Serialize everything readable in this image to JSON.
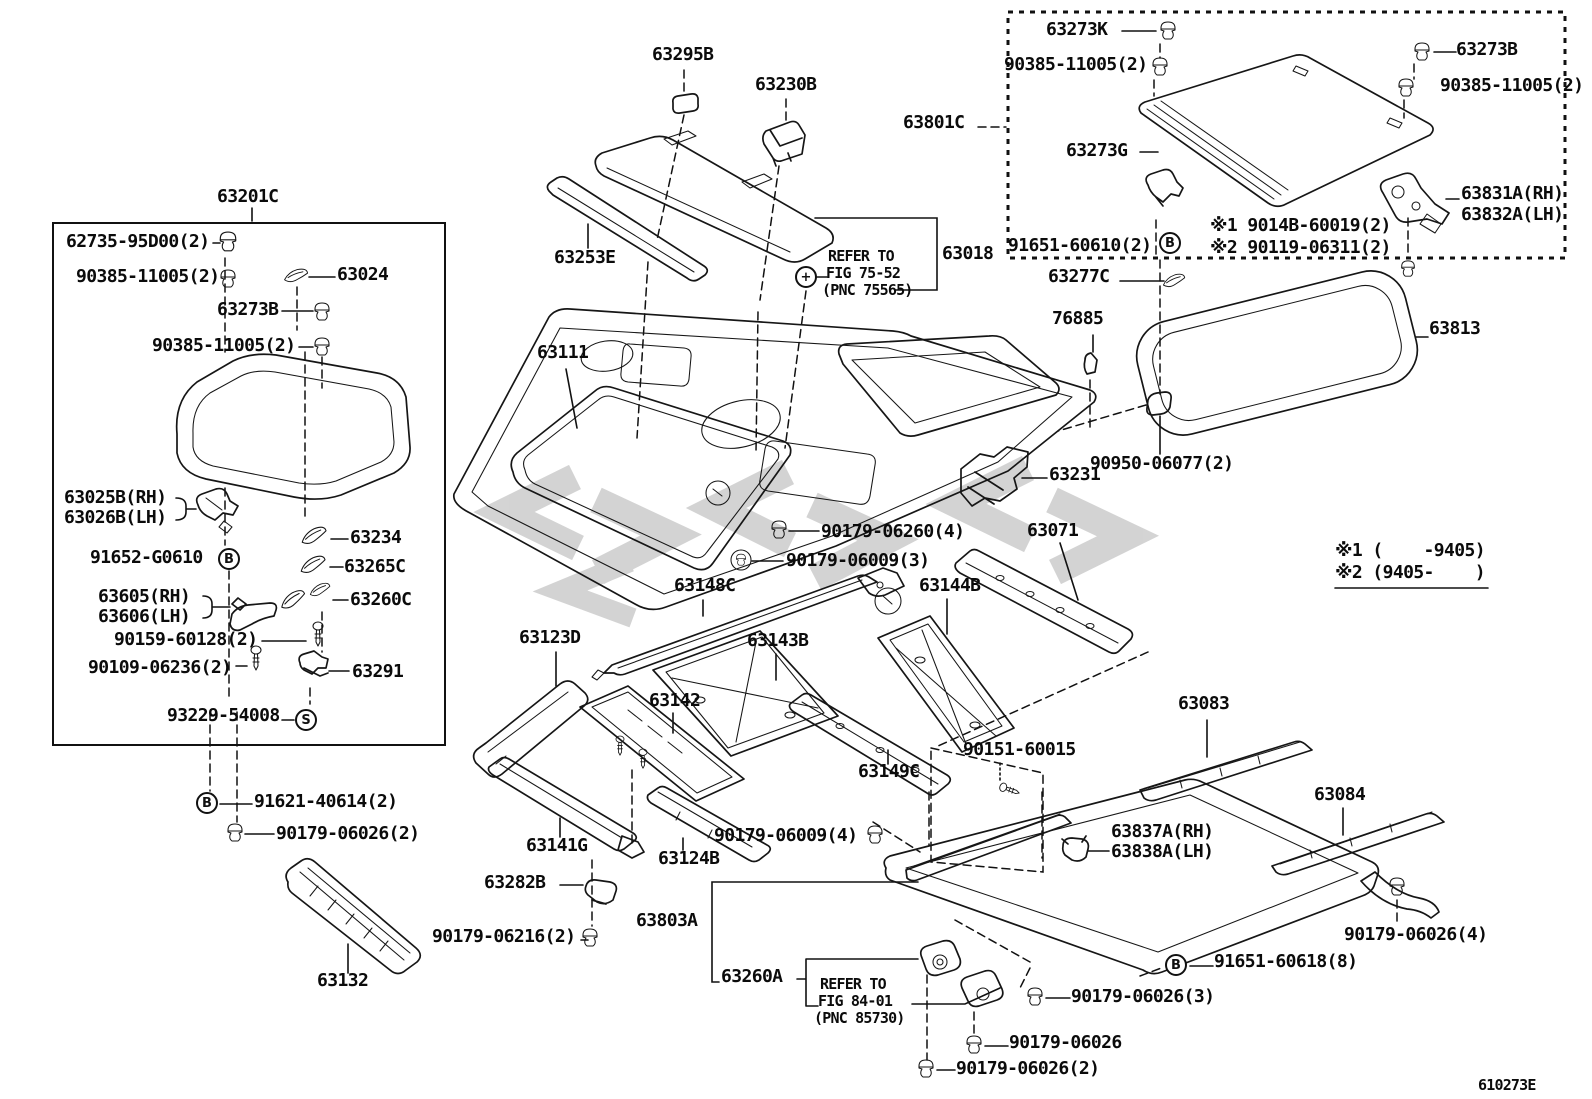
{
  "figure": {
    "code": "610273E"
  },
  "colors": {
    "line": "#161616",
    "background": "#ffffff",
    "watermark": "#c9c9c9"
  },
  "notes": {
    "production_note_1": "※1 (    -9405)",
    "production_note_2": "※2 (9405-    )"
  },
  "labels": [
    {
      "text": "63295B",
      "x": 652,
      "y": 46
    },
    {
      "text": "63230B",
      "x": 755,
      "y": 76
    },
    {
      "text": "63801C",
      "x": 903,
      "y": 114
    },
    {
      "text": "63273K",
      "x": 1046,
      "y": 21
    },
    {
      "text": "90385-11005(2)",
      "x": 1004,
      "y": 56
    },
    {
      "text": "63273B",
      "x": 1456,
      "y": 41
    },
    {
      "text": "90385-11005(2)",
      "x": 1440,
      "y": 77
    },
    {
      "text": "63273G",
      "x": 1066,
      "y": 142
    },
    {
      "text": "63831A(RH)",
      "x": 1461,
      "y": 185
    },
    {
      "text": "63832A(LH)",
      "x": 1461,
      "y": 206
    },
    {
      "text": "91651-60610(2)",
      "x": 1008,
      "y": 237
    },
    {
      "text": "※1 9014B-60019(2)",
      "x": 1210,
      "y": 217
    },
    {
      "text": "※2 90119-06311(2)",
      "x": 1210,
      "y": 239
    },
    {
      "text": "63018",
      "x": 942,
      "y": 245
    },
    {
      "text": "REFER TO",
      "x": 828,
      "y": 249,
      "size": "sm"
    },
    {
      "text": "FIG 75-52",
      "x": 826,
      "y": 266,
      "size": "sm"
    },
    {
      "text": "(PNC 75565)",
      "x": 822,
      "y": 283,
      "size": "sm"
    },
    {
      "text": "63253E",
      "x": 554,
      "y": 249
    },
    {
      "text": "63277C",
      "x": 1048,
      "y": 268
    },
    {
      "text": "76885",
      "x": 1052,
      "y": 310
    },
    {
      "text": "63813",
      "x": 1429,
      "y": 320
    },
    {
      "text": "90950-06077(2)",
      "x": 1090,
      "y": 455
    },
    {
      "text": "63201C",
      "x": 217,
      "y": 188
    },
    {
      "text": "62735-95D00(2)",
      "x": 66,
      "y": 233
    },
    {
      "text": "90385-11005(2)",
      "x": 76,
      "y": 268
    },
    {
      "text": "63024",
      "x": 337,
      "y": 266
    },
    {
      "text": "63273B",
      "x": 217,
      "y": 301
    },
    {
      "text": "90385-11005(2)",
      "x": 152,
      "y": 337
    },
    {
      "text": "63025B(RH)",
      "x": 64,
      "y": 489
    },
    {
      "text": "63026B(LH)",
      "x": 64,
      "y": 509
    },
    {
      "text": "91652-G0610",
      "x": 90,
      "y": 549
    },
    {
      "text": "63234",
      "x": 350,
      "y": 529
    },
    {
      "text": "63265C",
      "x": 344,
      "y": 558
    },
    {
      "text": "63605(RH)",
      "x": 98,
      "y": 588
    },
    {
      "text": "63606(LH)",
      "x": 98,
      "y": 608
    },
    {
      "text": "63260C",
      "x": 350,
      "y": 591
    },
    {
      "text": "90159-60128(2)",
      "x": 114,
      "y": 631
    },
    {
      "text": "90109-06236(2)",
      "x": 88,
      "y": 659
    },
    {
      "text": "63291",
      "x": 352,
      "y": 663
    },
    {
      "text": "93229-54008",
      "x": 167,
      "y": 707
    },
    {
      "text": "63111",
      "x": 537,
      "y": 344
    },
    {
      "text": "63231",
      "x": 1049,
      "y": 466
    },
    {
      "text": "90179-06260(4)",
      "x": 821,
      "y": 523
    },
    {
      "text": "90179-06009(3)",
      "x": 786,
      "y": 552
    },
    {
      "text": "63071",
      "x": 1027,
      "y": 522
    },
    {
      "text": "※1 (    -9405)",
      "x": 1335,
      "y": 542
    },
    {
      "text": "※2 (9405-    )",
      "x": 1335,
      "y": 564
    },
    {
      "text": "63148C",
      "x": 674,
      "y": 577
    },
    {
      "text": "63144B",
      "x": 919,
      "y": 577
    },
    {
      "text": "63123D",
      "x": 519,
      "y": 629
    },
    {
      "text": "63143B",
      "x": 747,
      "y": 632
    },
    {
      "text": "63142",
      "x": 649,
      "y": 692
    },
    {
      "text": "63149C",
      "x": 858,
      "y": 763
    },
    {
      "text": "63083",
      "x": 1178,
      "y": 695
    },
    {
      "text": "90151-60015",
      "x": 963,
      "y": 741
    },
    {
      "text": "63084",
      "x": 1314,
      "y": 786
    },
    {
      "text": "63837A(RH)",
      "x": 1111,
      "y": 823
    },
    {
      "text": "63838A(LH)",
      "x": 1111,
      "y": 843
    },
    {
      "text": "91621-40614(2)",
      "x": 254,
      "y": 793
    },
    {
      "text": "90179-06026(2)",
      "x": 276,
      "y": 825
    },
    {
      "text": "63141G",
      "x": 526,
      "y": 837
    },
    {
      "text": "63282B",
      "x": 484,
      "y": 874
    },
    {
      "text": "90179-06216(2)",
      "x": 432,
      "y": 928
    },
    {
      "text": "63132",
      "x": 317,
      "y": 972
    },
    {
      "text": "90179-06009(4)",
      "x": 714,
      "y": 827
    },
    {
      "text": "63124B",
      "x": 658,
      "y": 850
    },
    {
      "text": "63803A",
      "x": 636,
      "y": 912
    },
    {
      "text": "63260A",
      "x": 721,
      "y": 968
    },
    {
      "text": "REFER TO",
      "x": 820,
      "y": 977,
      "size": "sm"
    },
    {
      "text": "FIG 84-01",
      "x": 818,
      "y": 994,
      "size": "sm"
    },
    {
      "text": "(PNC 85730)",
      "x": 814,
      "y": 1011,
      "size": "sm"
    },
    {
      "text": "90179-06026(4)",
      "x": 1344,
      "y": 926
    },
    {
      "text": "91651-60618(8)",
      "x": 1214,
      "y": 953
    },
    {
      "text": "90179-06026(3)",
      "x": 1071,
      "y": 988
    },
    {
      "text": "90179-06026",
      "x": 1009,
      "y": 1034
    },
    {
      "text": "90179-06026(2)",
      "x": 956,
      "y": 1060
    }
  ],
  "markers": [
    {
      "glyph": "B",
      "cx": 1170,
      "cy": 243
    },
    {
      "glyph": "B",
      "cx": 229,
      "cy": 559
    },
    {
      "glyph": "S",
      "cx": 306,
      "cy": 720
    },
    {
      "glyph": "B",
      "cx": 207,
      "cy": 803
    },
    {
      "glyph": "B",
      "cx": 1176,
      "cy": 965
    },
    {
      "glyph": "+",
      "cx": 806,
      "cy": 277
    }
  ]
}
